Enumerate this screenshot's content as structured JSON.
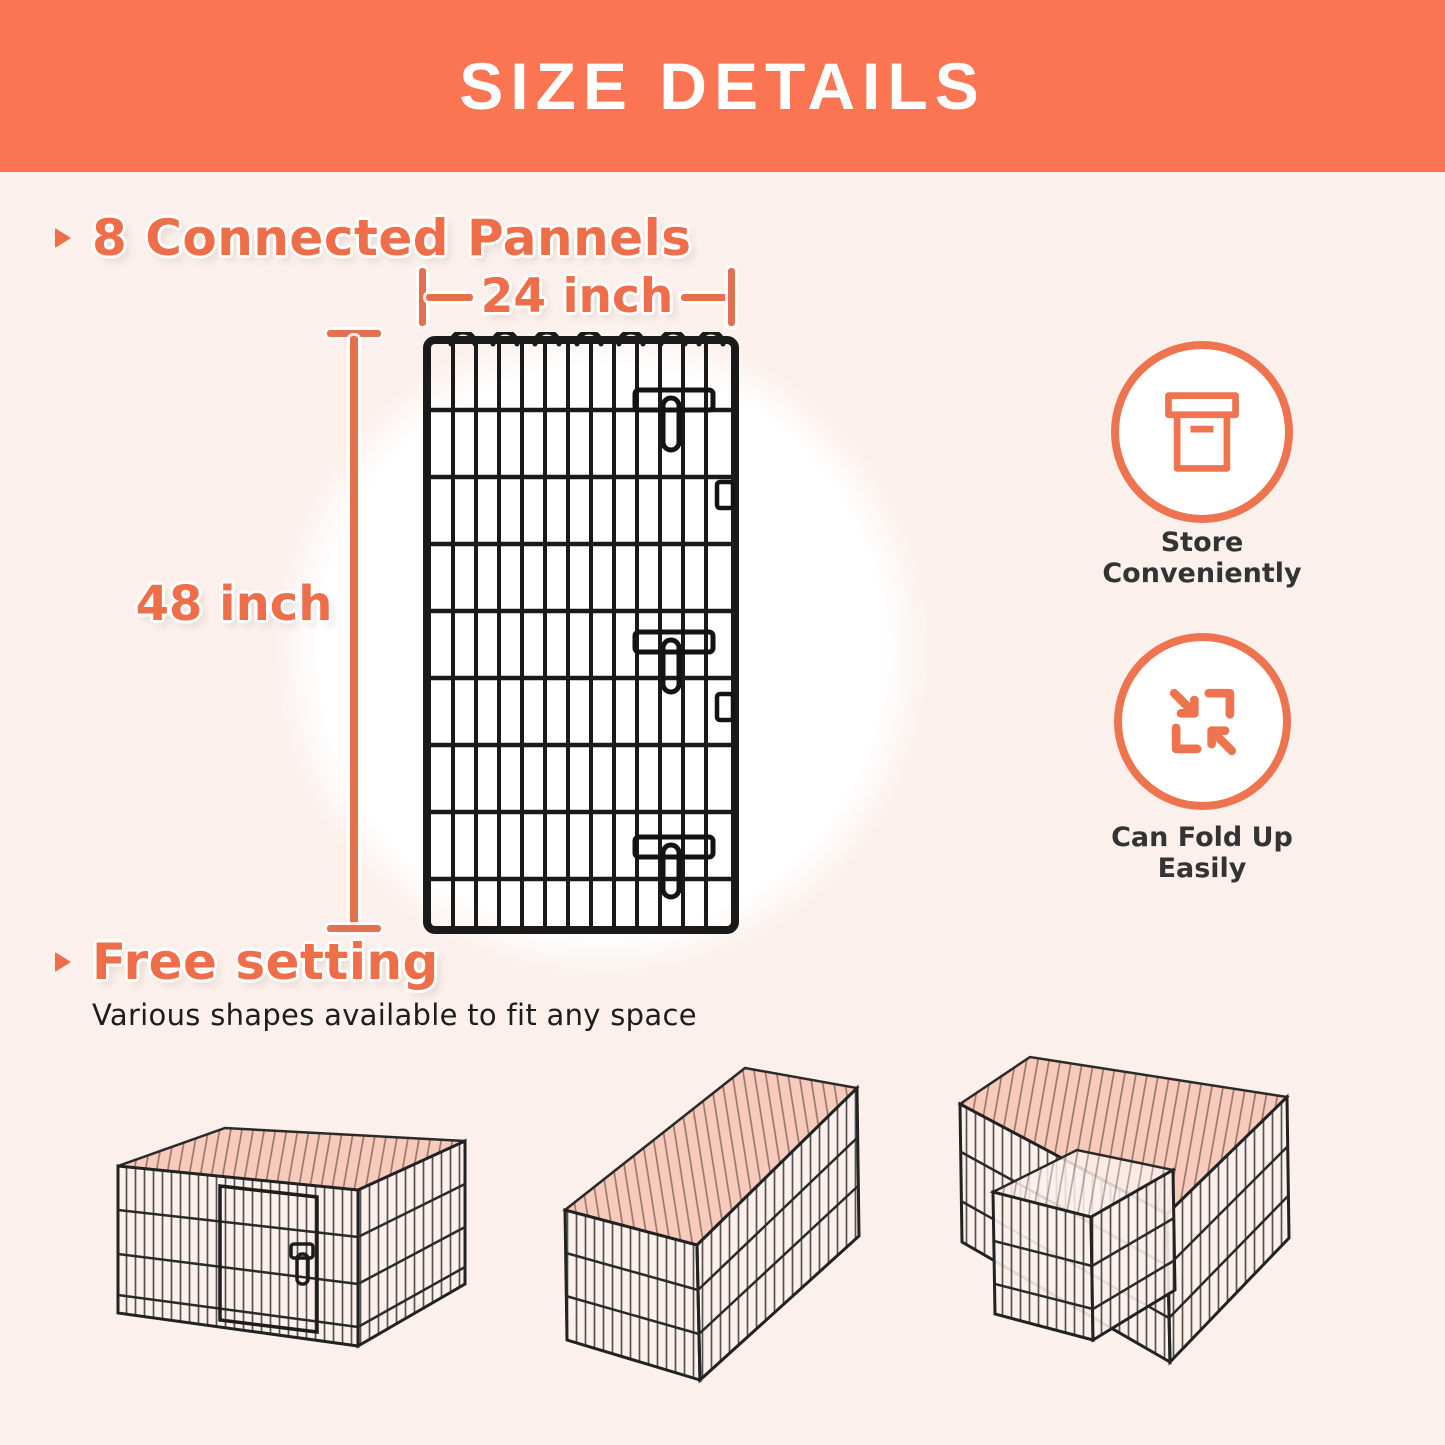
{
  "header": {
    "title": "SIZE DETAILS"
  },
  "panel_section": {
    "heading": "8 Connected Pannels",
    "width_label": "24 inch",
    "height_label": "48 inch",
    "panel_image": "black-wire-panel-front-view"
  },
  "features": [
    {
      "icon": "storage-box-icon",
      "line1": "Store",
      "line2": "Conveniently"
    },
    {
      "icon": "fold-arrows-icon",
      "line1": "Can Fold Up",
      "line2": "Easily"
    }
  ],
  "free_setting_section": {
    "heading": "Free setting",
    "description": "Various shapes available to fit any space",
    "shapes": [
      {
        "image": "square-playpen"
      },
      {
        "image": "long-rectangle-playpen"
      },
      {
        "image": "l-shape-playpen"
      }
    ]
  },
  "colors": {
    "header_bg": "#FB7553",
    "accent_text": "#EE6E4A",
    "measure_line": "#E2714F",
    "icon_stroke": "#EE7450",
    "background": "#FBF0EB",
    "pen_top_pink": "#F6C7B6",
    "dark_text": "#2E2E2E"
  }
}
